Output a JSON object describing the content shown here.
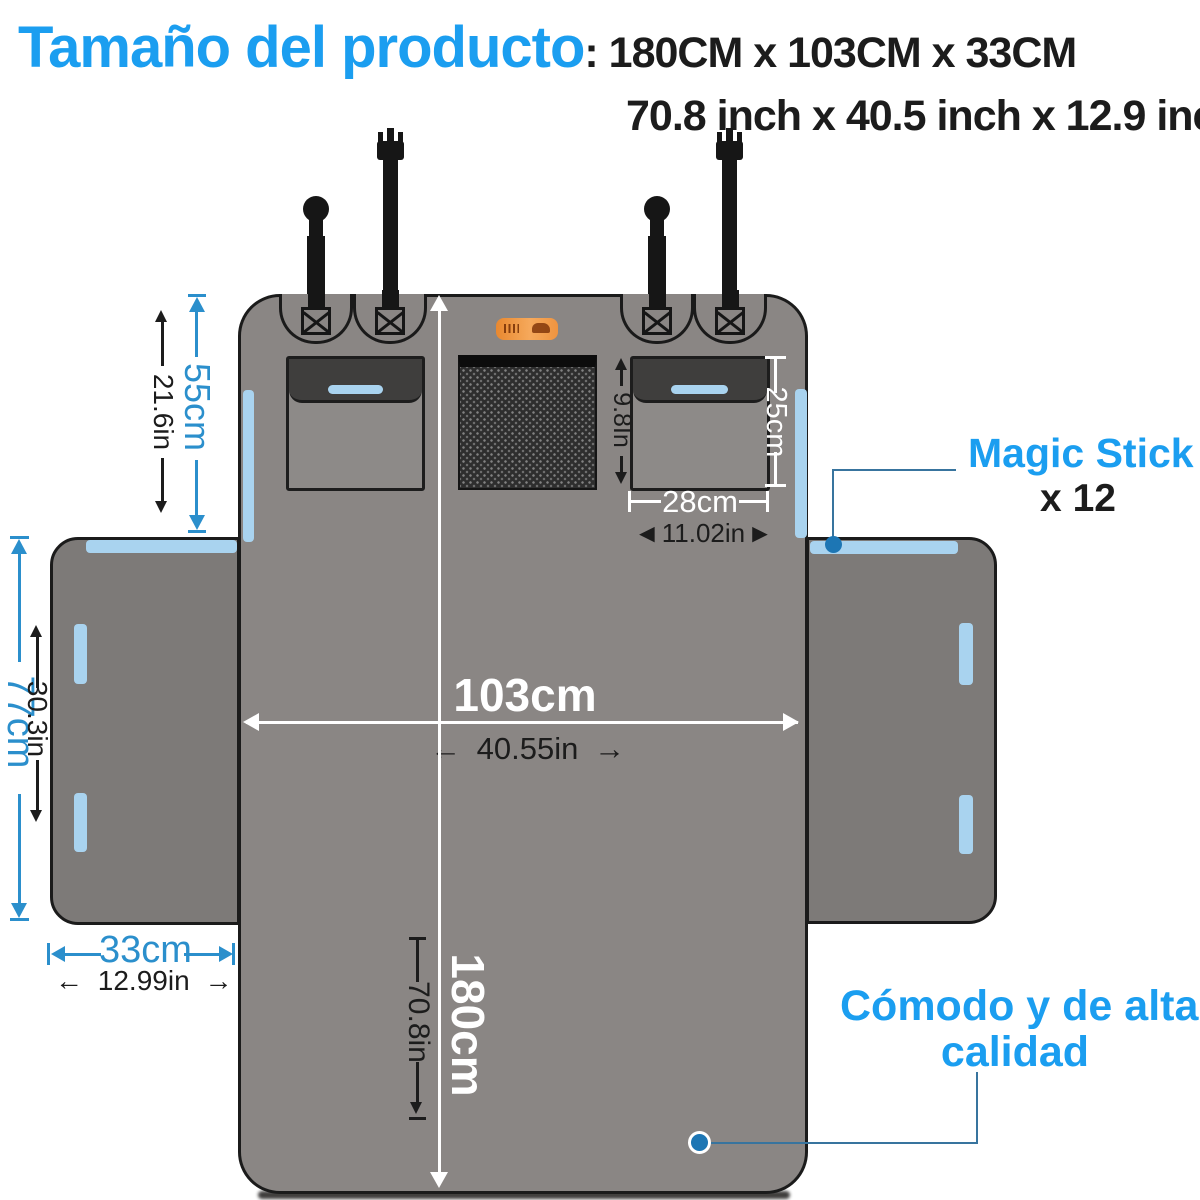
{
  "header": {
    "title": "Tamaño del producto",
    "size_cm": ": 180CM x 103CM x 33CM",
    "size_inch": "70.8 inch x 40.5 inch x 12.9 inch"
  },
  "callouts": {
    "magic_stick_label": "Magic Stick",
    "magic_stick_count": "x 12",
    "quality_line1": "Cómodo y de alta",
    "quality_line2": "calidad"
  },
  "dimensions": {
    "back_height_cm": "55cm",
    "back_height_in": "21.6in",
    "side_flap_width_cm": "77cm",
    "side_flap_width_in": "30.3in",
    "flap_depth_cm": "33cm",
    "flap_depth_in": "12.99in",
    "width_cm": "103cm",
    "width_in": "40.55in",
    "length_cm": "180cm",
    "length_in": "70.8in",
    "pocket_width_cm": "28cm",
    "pocket_width_in": "11.02in",
    "pocket_height_cm": "25cm",
    "mesh_height_in": "9.8In"
  },
  "arrows": {
    "left": "←",
    "right": "→",
    "solid_left": "◄",
    "solid_right": "►"
  },
  "colors": {
    "title_blue": "#1b9ef0",
    "dim_blue": "#2b8fcc",
    "velcro_blue": "#a9d3ef",
    "panel_gray": "#8a8684",
    "flap_gray": "#7d7a78",
    "pocket_gray": "#8d8a88",
    "pocket_flap_dark": "#3f3e3d",
    "strap_black": "#161616",
    "logo_orange": "#f09440",
    "dim_black": "#1c1c1c",
    "callout_line": "#38749e",
    "dot_blue": "#1d76b4"
  }
}
